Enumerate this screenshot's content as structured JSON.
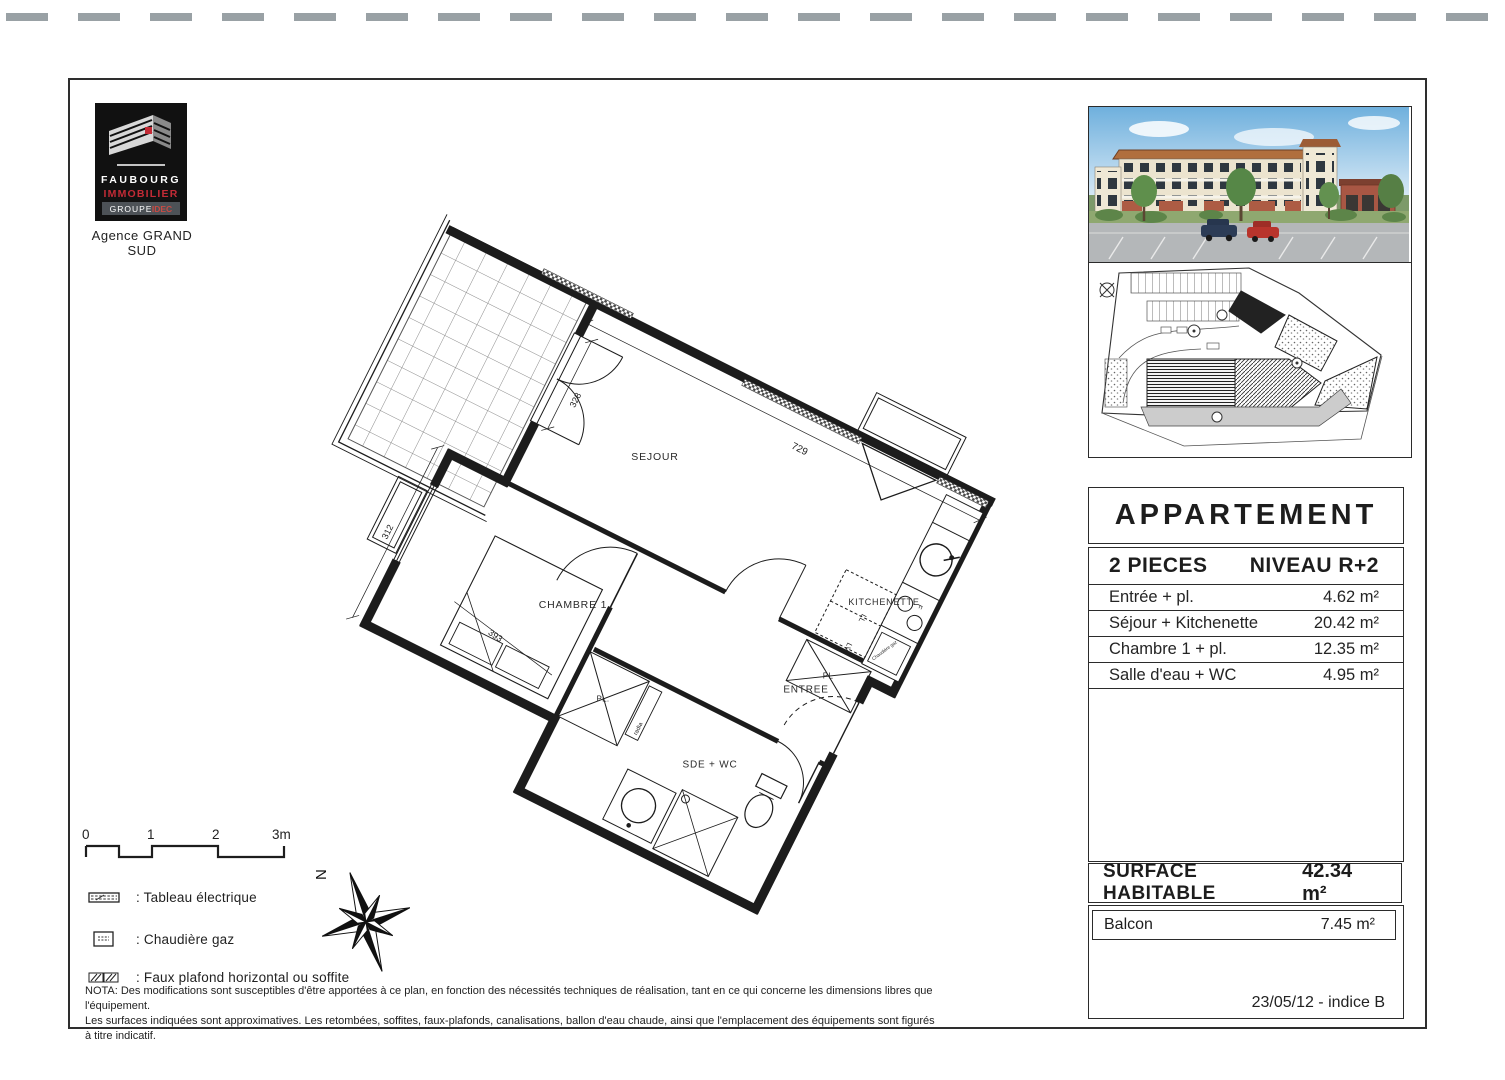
{
  "logo": {
    "brand_top": "FAUBOURG",
    "brand_bottom": "IMMOBILIER",
    "group_left": "GROUPE",
    "group_right": "IDEC",
    "agency": "Agence GRAND SUD"
  },
  "plan": {
    "rooms": {
      "sejour": "SEJOUR",
      "kitchenette": "KITCHENETTE",
      "chambre": "CHAMBRE 1",
      "entree": "ENTREE",
      "sde": "SDE + WC"
    },
    "labels": {
      "pl_entree": "PL",
      "pl_chambre": "PL.",
      "radiator": "radia",
      "washer": "LL",
      "dishwasher": "LV",
      "stove": "F",
      "boiler": "Chaudière gaz"
    },
    "dims": {
      "sejour_width": "729",
      "balcony_door": "328",
      "chambre_depth": "312",
      "chambre_width": "393"
    },
    "compass_north": "N"
  },
  "scalebar": {
    "ticks": [
      "0",
      "1",
      "2",
      "3m"
    ]
  },
  "legend": {
    "items": [
      {
        "label": ": Tableau électrique"
      },
      {
        "label": ": Chaudière gaz"
      },
      {
        "label": ": Faux plafond horizontal ou soffite"
      }
    ]
  },
  "nota": {
    "line1": "NOTA: Des modifications sont susceptibles d'être apportées à ce plan, en fonction des nécessités techniques de réalisation, tant en ce qui concerne les dimensions libres que l'équipement.",
    "line2": "Les surfaces indiquées sont approximatives. Les retombées, soffites, faux-plafonds, canalisations, ballon d'eau chaude, ainsi que l'emplacement des équipements sont figurés à titre indicatif."
  },
  "panel": {
    "title": "APPARTEMENT",
    "type": {
      "left": "2 PIECES",
      "right": "NIVEAU R+2"
    },
    "rows": [
      {
        "label": "Entrée + pl.",
        "value": "4.62 m²"
      },
      {
        "label": "Séjour + Kitchenette",
        "value": "20.42 m²"
      },
      {
        "label": "Chambre 1 + pl.",
        "value": "12.35 m²"
      },
      {
        "label": "Salle d'eau + WC",
        "value": "4.95 m²"
      }
    ],
    "surface": {
      "label": "SURFACE HABITABLE",
      "value": "42.34 m²"
    },
    "balcony": {
      "label": "Balcon",
      "value": "7.45 m²"
    },
    "revision": "23/05/12 - indice B"
  },
  "colors": {
    "logo_red": "#c32b36",
    "ink": "#1d1d1d",
    "paper": "#ffffff"
  }
}
